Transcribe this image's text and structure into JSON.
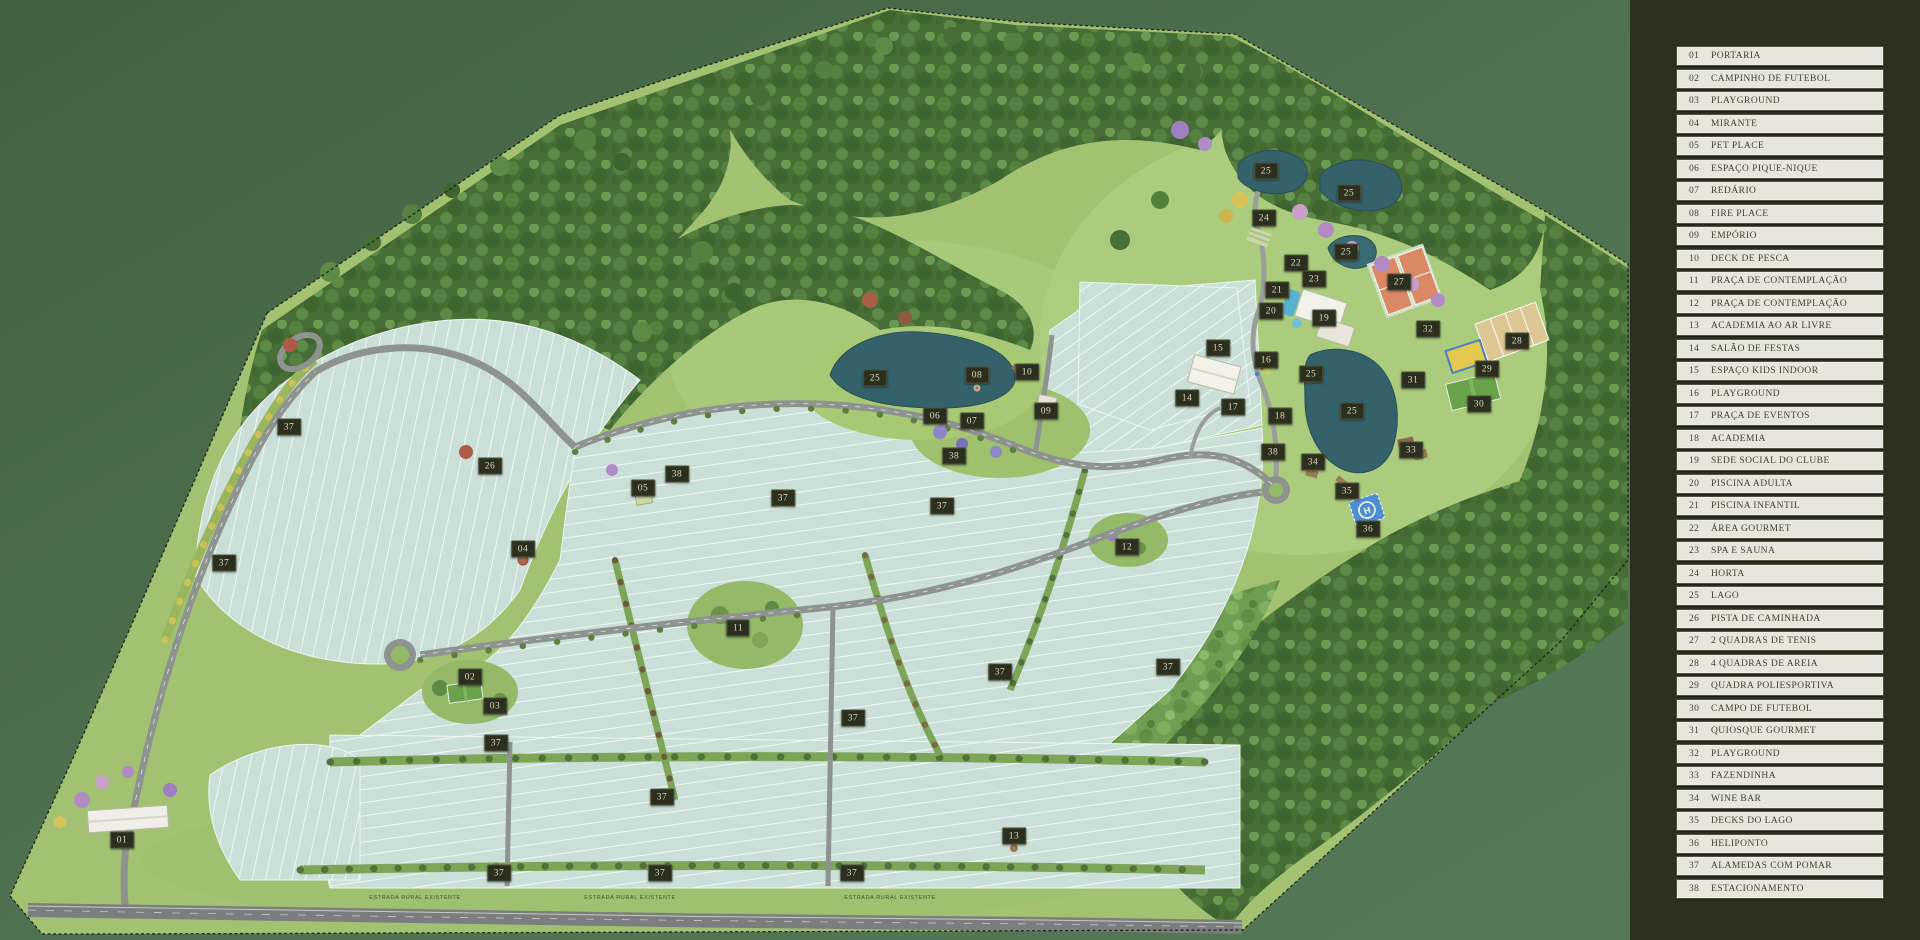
{
  "map": {
    "road_labels": [
      {
        "text": "ESTRADA RURAL EXISTENTE",
        "x": 415,
        "y": 898
      },
      {
        "text": "ESTRADA RURAL EXISTENTE",
        "x": 630,
        "y": 898
      },
      {
        "text": "ESTRADA RURAL EXISTENTE",
        "x": 890,
        "y": 898
      }
    ],
    "markers": [
      {
        "n": "01",
        "x": 122,
        "y": 840
      },
      {
        "n": "02",
        "x": 470,
        "y": 677
      },
      {
        "n": "03",
        "x": 495,
        "y": 706
      },
      {
        "n": "04",
        "x": 523,
        "y": 549
      },
      {
        "n": "05",
        "x": 643,
        "y": 488
      },
      {
        "n": "06",
        "x": 935,
        "y": 416
      },
      {
        "n": "07",
        "x": 972,
        "y": 421
      },
      {
        "n": "08",
        "x": 977,
        "y": 375
      },
      {
        "n": "09",
        "x": 1046,
        "y": 411
      },
      {
        "n": "10",
        "x": 1027,
        "y": 372
      },
      {
        "n": "11",
        "x": 738,
        "y": 628
      },
      {
        "n": "12",
        "x": 1127,
        "y": 547
      },
      {
        "n": "13",
        "x": 1014,
        "y": 836
      },
      {
        "n": "14",
        "x": 1187,
        "y": 398
      },
      {
        "n": "15",
        "x": 1218,
        "y": 348
      },
      {
        "n": "16",
        "x": 1266,
        "y": 360
      },
      {
        "n": "17",
        "x": 1233,
        "y": 407
      },
      {
        "n": "18",
        "x": 1280,
        "y": 416
      },
      {
        "n": "19",
        "x": 1324,
        "y": 318
      },
      {
        "n": "20",
        "x": 1271,
        "y": 311
      },
      {
        "n": "21",
        "x": 1277,
        "y": 290
      },
      {
        "n": "22",
        "x": 1296,
        "y": 263
      },
      {
        "n": "23",
        "x": 1314,
        "y": 279
      },
      {
        "n": "24",
        "x": 1264,
        "y": 218
      },
      {
        "n": "25",
        "x": 1266,
        "y": 171
      },
      {
        "n": "25",
        "x": 1349,
        "y": 193
      },
      {
        "n": "25",
        "x": 1346,
        "y": 252
      },
      {
        "n": "25",
        "x": 875,
        "y": 378
      },
      {
        "n": "25",
        "x": 1311,
        "y": 374
      },
      {
        "n": "25",
        "x": 1352,
        "y": 411
      },
      {
        "n": "26",
        "x": 490,
        "y": 466
      },
      {
        "n": "27",
        "x": 1399,
        "y": 282
      },
      {
        "n": "28",
        "x": 1517,
        "y": 341
      },
      {
        "n": "29",
        "x": 1487,
        "y": 369
      },
      {
        "n": "30",
        "x": 1479,
        "y": 404
      },
      {
        "n": "31",
        "x": 1413,
        "y": 380
      },
      {
        "n": "32",
        "x": 1428,
        "y": 329
      },
      {
        "n": "33",
        "x": 1411,
        "y": 450
      },
      {
        "n": "34",
        "x": 1313,
        "y": 462
      },
      {
        "n": "35",
        "x": 1347,
        "y": 491
      },
      {
        "n": "36",
        "x": 1368,
        "y": 529
      },
      {
        "n": "37",
        "x": 289,
        "y": 427
      },
      {
        "n": "37",
        "x": 224,
        "y": 563
      },
      {
        "n": "37",
        "x": 783,
        "y": 498
      },
      {
        "n": "37",
        "x": 942,
        "y": 506
      },
      {
        "n": "37",
        "x": 496,
        "y": 743
      },
      {
        "n": "37",
        "x": 662,
        "y": 797
      },
      {
        "n": "37",
        "x": 853,
        "y": 718
      },
      {
        "n": "37",
        "x": 1000,
        "y": 672
      },
      {
        "n": "37",
        "x": 1168,
        "y": 667
      },
      {
        "n": "37",
        "x": 499,
        "y": 873
      },
      {
        "n": "37",
        "x": 660,
        "y": 873
      },
      {
        "n": "37",
        "x": 852,
        "y": 873
      },
      {
        "n": "38",
        "x": 677,
        "y": 474
      },
      {
        "n": "38",
        "x": 954,
        "y": 456
      },
      {
        "n": "38",
        "x": 1273,
        "y": 452
      }
    ]
  },
  "legend": {
    "items": [
      {
        "num": "01",
        "label": "PORTARIA"
      },
      {
        "num": "02",
        "label": "CAMPINHO DE FUTEBOL"
      },
      {
        "num": "03",
        "label": "PLAYGROUND"
      },
      {
        "num": "04",
        "label": "MIRANTE"
      },
      {
        "num": "05",
        "label": "PET PLACE"
      },
      {
        "num": "06",
        "label": "ESPAÇO PIQUE-NIQUE"
      },
      {
        "num": "07",
        "label": "REDÁRIO"
      },
      {
        "num": "08",
        "label": "FIRE PLACE"
      },
      {
        "num": "09",
        "label": "EMPÓRIO"
      },
      {
        "num": "10",
        "label": "DECK DE PESCA"
      },
      {
        "num": "11",
        "label": "PRAÇA DE CONTEMPLAÇÃO"
      },
      {
        "num": "12",
        "label": "PRAÇA DE CONTEMPLAÇÃO"
      },
      {
        "num": "13",
        "label": "ACADEMIA AO AR LIVRE"
      },
      {
        "num": "14",
        "label": "SALÃO DE FESTAS"
      },
      {
        "num": "15",
        "label": "ESPAÇO KIDS INDOOR"
      },
      {
        "num": "16",
        "label": "PLAYGROUND"
      },
      {
        "num": "17",
        "label": "PRAÇA DE EVENTOS"
      },
      {
        "num": "18",
        "label": "ACADEMIA"
      },
      {
        "num": "19",
        "label": "SEDE SOCIAL DO CLUBE"
      },
      {
        "num": "20",
        "label": "PISCINA ADULTA"
      },
      {
        "num": "21",
        "label": "PISCINA INFANTIL"
      },
      {
        "num": "22",
        "label": "ÁREA GOURMET"
      },
      {
        "num": "23",
        "label": "SPA E SAUNA"
      },
      {
        "num": "24",
        "label": "HORTA"
      },
      {
        "num": "25",
        "label": "LAGO"
      },
      {
        "num": "26",
        "label": "PISTA DE CAMINHADA"
      },
      {
        "num": "27",
        "label": "2 QUADRAS DE TENIS"
      },
      {
        "num": "28",
        "label": "4 QUADRAS DE AREIA"
      },
      {
        "num": "29",
        "label": "QUADRA POLIESPORTIVA"
      },
      {
        "num": "30",
        "label": "CAMPO DE FUTEBOL"
      },
      {
        "num": "31",
        "label": "QUIOSQUE GOURMET"
      },
      {
        "num": "32",
        "label": "PLAYGROUND"
      },
      {
        "num": "33",
        "label": "FAZENDINHA"
      },
      {
        "num": "34",
        "label": "WINE BAR"
      },
      {
        "num": "35",
        "label": "DECKS DO LAGO"
      },
      {
        "num": "36",
        "label": "HELIPONTO"
      },
      {
        "num": "37",
        "label": "ALAMEDAS COM POMAR"
      },
      {
        "num": "38",
        "label": "ESTACIONAMENTO"
      }
    ]
  },
  "colors": {
    "outside_green": "#4d6e4d",
    "lawn": "#a2c272",
    "lots": "#cbdfd9",
    "road": "#8e938f",
    "lake": "#35626a",
    "highway": "#7b7d7e",
    "badge_bg": "#2c2f1d",
    "badge_text": "#ded9c2",
    "panel_bg": "#2d301e",
    "legend_item_bg": "#e7e6dd",
    "legend_text": "#3f402e"
  }
}
